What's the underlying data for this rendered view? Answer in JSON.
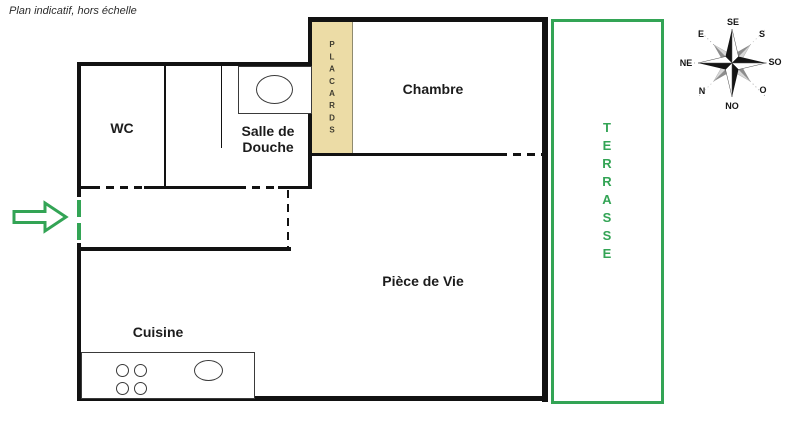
{
  "note": "Plan indicatif, hors échelle",
  "colors": {
    "green": "#33a455",
    "wall": "#121212",
    "label": "#1c1c1c",
    "fixture": "#3a3a3a",
    "placard_fill": "#ecdca6",
    "placard_border": "#8f8a6e",
    "placard_text": "#3f3c30"
  },
  "rooms": {
    "wc": {
      "label": "WC"
    },
    "shower": {
      "label": "Salle de Douche"
    },
    "bedroom": {
      "label": "Chambre"
    },
    "living": {
      "label": "Pièce de Vie"
    },
    "kitchen": {
      "label": "Cuisine"
    },
    "closets": {
      "label": "PLACARDS"
    },
    "terrace": {
      "label": "TERRASSE"
    }
  },
  "compass": {
    "labels": {
      "se": "SE",
      "s": "S",
      "so": "SO",
      "o": "O",
      "no": "NO",
      "n": "N",
      "ne": "NE",
      "e": "E"
    }
  },
  "icons": {
    "entrance_arrow": "green outlined block arrow pointing right",
    "compass_rose": "8-point star, black cardinal points and gray diagonal points",
    "washbasin": "ellipse inside rectangle",
    "kitchen_sink": "ellipse",
    "stove_burners": "four small circles"
  }
}
